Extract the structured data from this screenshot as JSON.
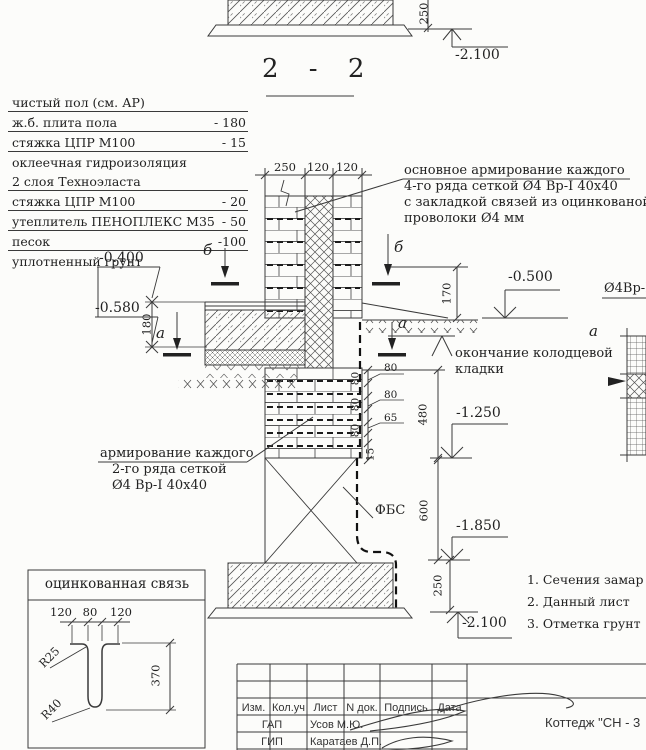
{
  "section": {
    "title": "2 - 2"
  },
  "floor_table": {
    "rows": [
      {
        "label": "чистый пол (см. АР)",
        "value": ""
      },
      {
        "label": "ж.б. плита пола",
        "value": "- 180"
      },
      {
        "label": "стяжка ЦПР М100",
        "value": "- 15"
      },
      {
        "label": "оклеечная гидроизоляция",
        "value": ""
      },
      {
        "label": "2 слоя Техноэласта",
        "value": ""
      },
      {
        "label": "стяжка ЦПР М100",
        "value": "- 20"
      },
      {
        "label": "утеплитель ПЕНОПЛЕКС М35",
        "value": "- 50"
      },
      {
        "label": "песок",
        "value": "-100"
      },
      {
        "label": "уплотненный грунт",
        "value": ""
      }
    ]
  },
  "annotations": {
    "main_reinf_l1": "основное армирование каждого",
    "main_reinf_l2": "4-го ряда сеткой Ø4 Вр-I 40x40",
    "main_reinf_l3": "с закладкой связей из оцинкованой",
    "main_reinf_l4": "проволоки Ø4 мм",
    "row2_reinf_l1": "армирование каждого",
    "row2_reinf_l2": "2-го ряда сеткой",
    "row2_reinf_l3": "Ø4 Вр-I 40x40",
    "well_end_l1": "окончание колодцевой",
    "well_end_l2": "кладки",
    "fbs": "ФБС",
    "mesh": "Ø4Вр-I",
    "mark_b": "б",
    "mark_a": "а"
  },
  "levels": {
    "top": "-2.100",
    "l0400": "-0.400",
    "l0580": "-0.580",
    "l0500": "-0.500",
    "l1250": "-1.250",
    "l1850": "-1.850",
    "bottom": "-2.100"
  },
  "dims": {
    "t250": "250",
    "t120a": "120",
    "t120b": "120",
    "d180": "180",
    "d170": "170",
    "d480": "480",
    "d600": "600",
    "d15": "15",
    "foot250a": "250",
    "foot250b": "250",
    "c80a": "80",
    "c80b": "80",
    "c80c": "80",
    "f80a": "80",
    "f80b": "80",
    "f65": "65"
  },
  "detail": {
    "title": "оцинкованная связь",
    "d120a": "120",
    "d80": "80",
    "d120b": "120",
    "d370": "370",
    "r25": "R25",
    "r40": "R40"
  },
  "notes": {
    "n1": "1. Сечения замар",
    "n2": "2. Данный лист",
    "n3": "3. Отметка грунт"
  },
  "title_block": {
    "h_izm": "Изм.",
    "h_kol": "Кол.уч",
    "h_list": "Лист",
    "h_ndok": "N док.",
    "h_podp": "Подпись",
    "h_data": "Дата",
    "r1_role": "ГАП",
    "r1_name": "Усов М.Ю.",
    "r2_role": "ГИП",
    "r2_name": "Каратаев Д.П.",
    "project": "Коттедж \"СН - 3"
  }
}
